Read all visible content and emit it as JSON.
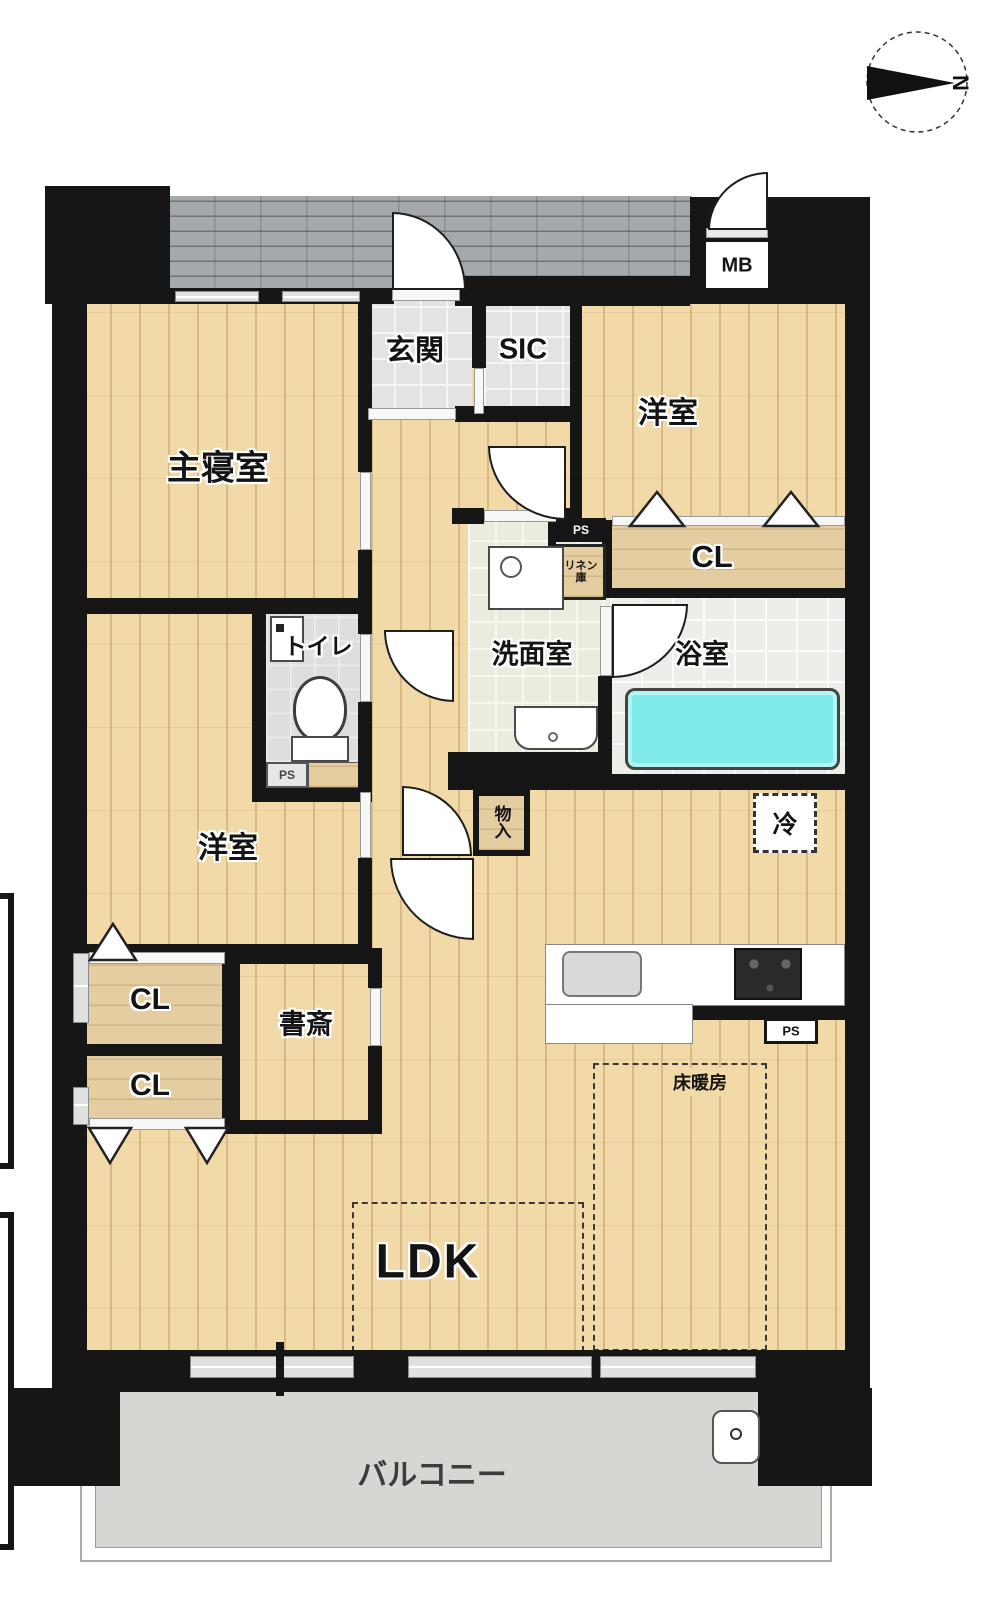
{
  "compass": {
    "north": "N"
  },
  "labels": {
    "master_bedroom": "主寝室",
    "entrance": "玄関",
    "sic": "SIC",
    "bedroom_ne": "洋室",
    "bedroom_sw": "洋室",
    "closet": "CL",
    "linen": "リネン庫",
    "washroom": "洗面室",
    "bathroom": "浴室",
    "toilet": "トイレ",
    "storage": "物入",
    "fridge": "冷",
    "study": "書斎",
    "ldk": "LDK",
    "floor_heating": "床暖房",
    "balcony": "バルコニー",
    "meter_box": "MB",
    "pipe_space": "PS"
  },
  "colors": {
    "wood_floor": "#f1d9a8",
    "closet_tan": "#e4cda0",
    "bathtub_cyan": "#7eeaea",
    "balcony_gray": "#d6d6d2",
    "corridor_gray": "#a6a9ab",
    "wall_black": "#161616"
  }
}
